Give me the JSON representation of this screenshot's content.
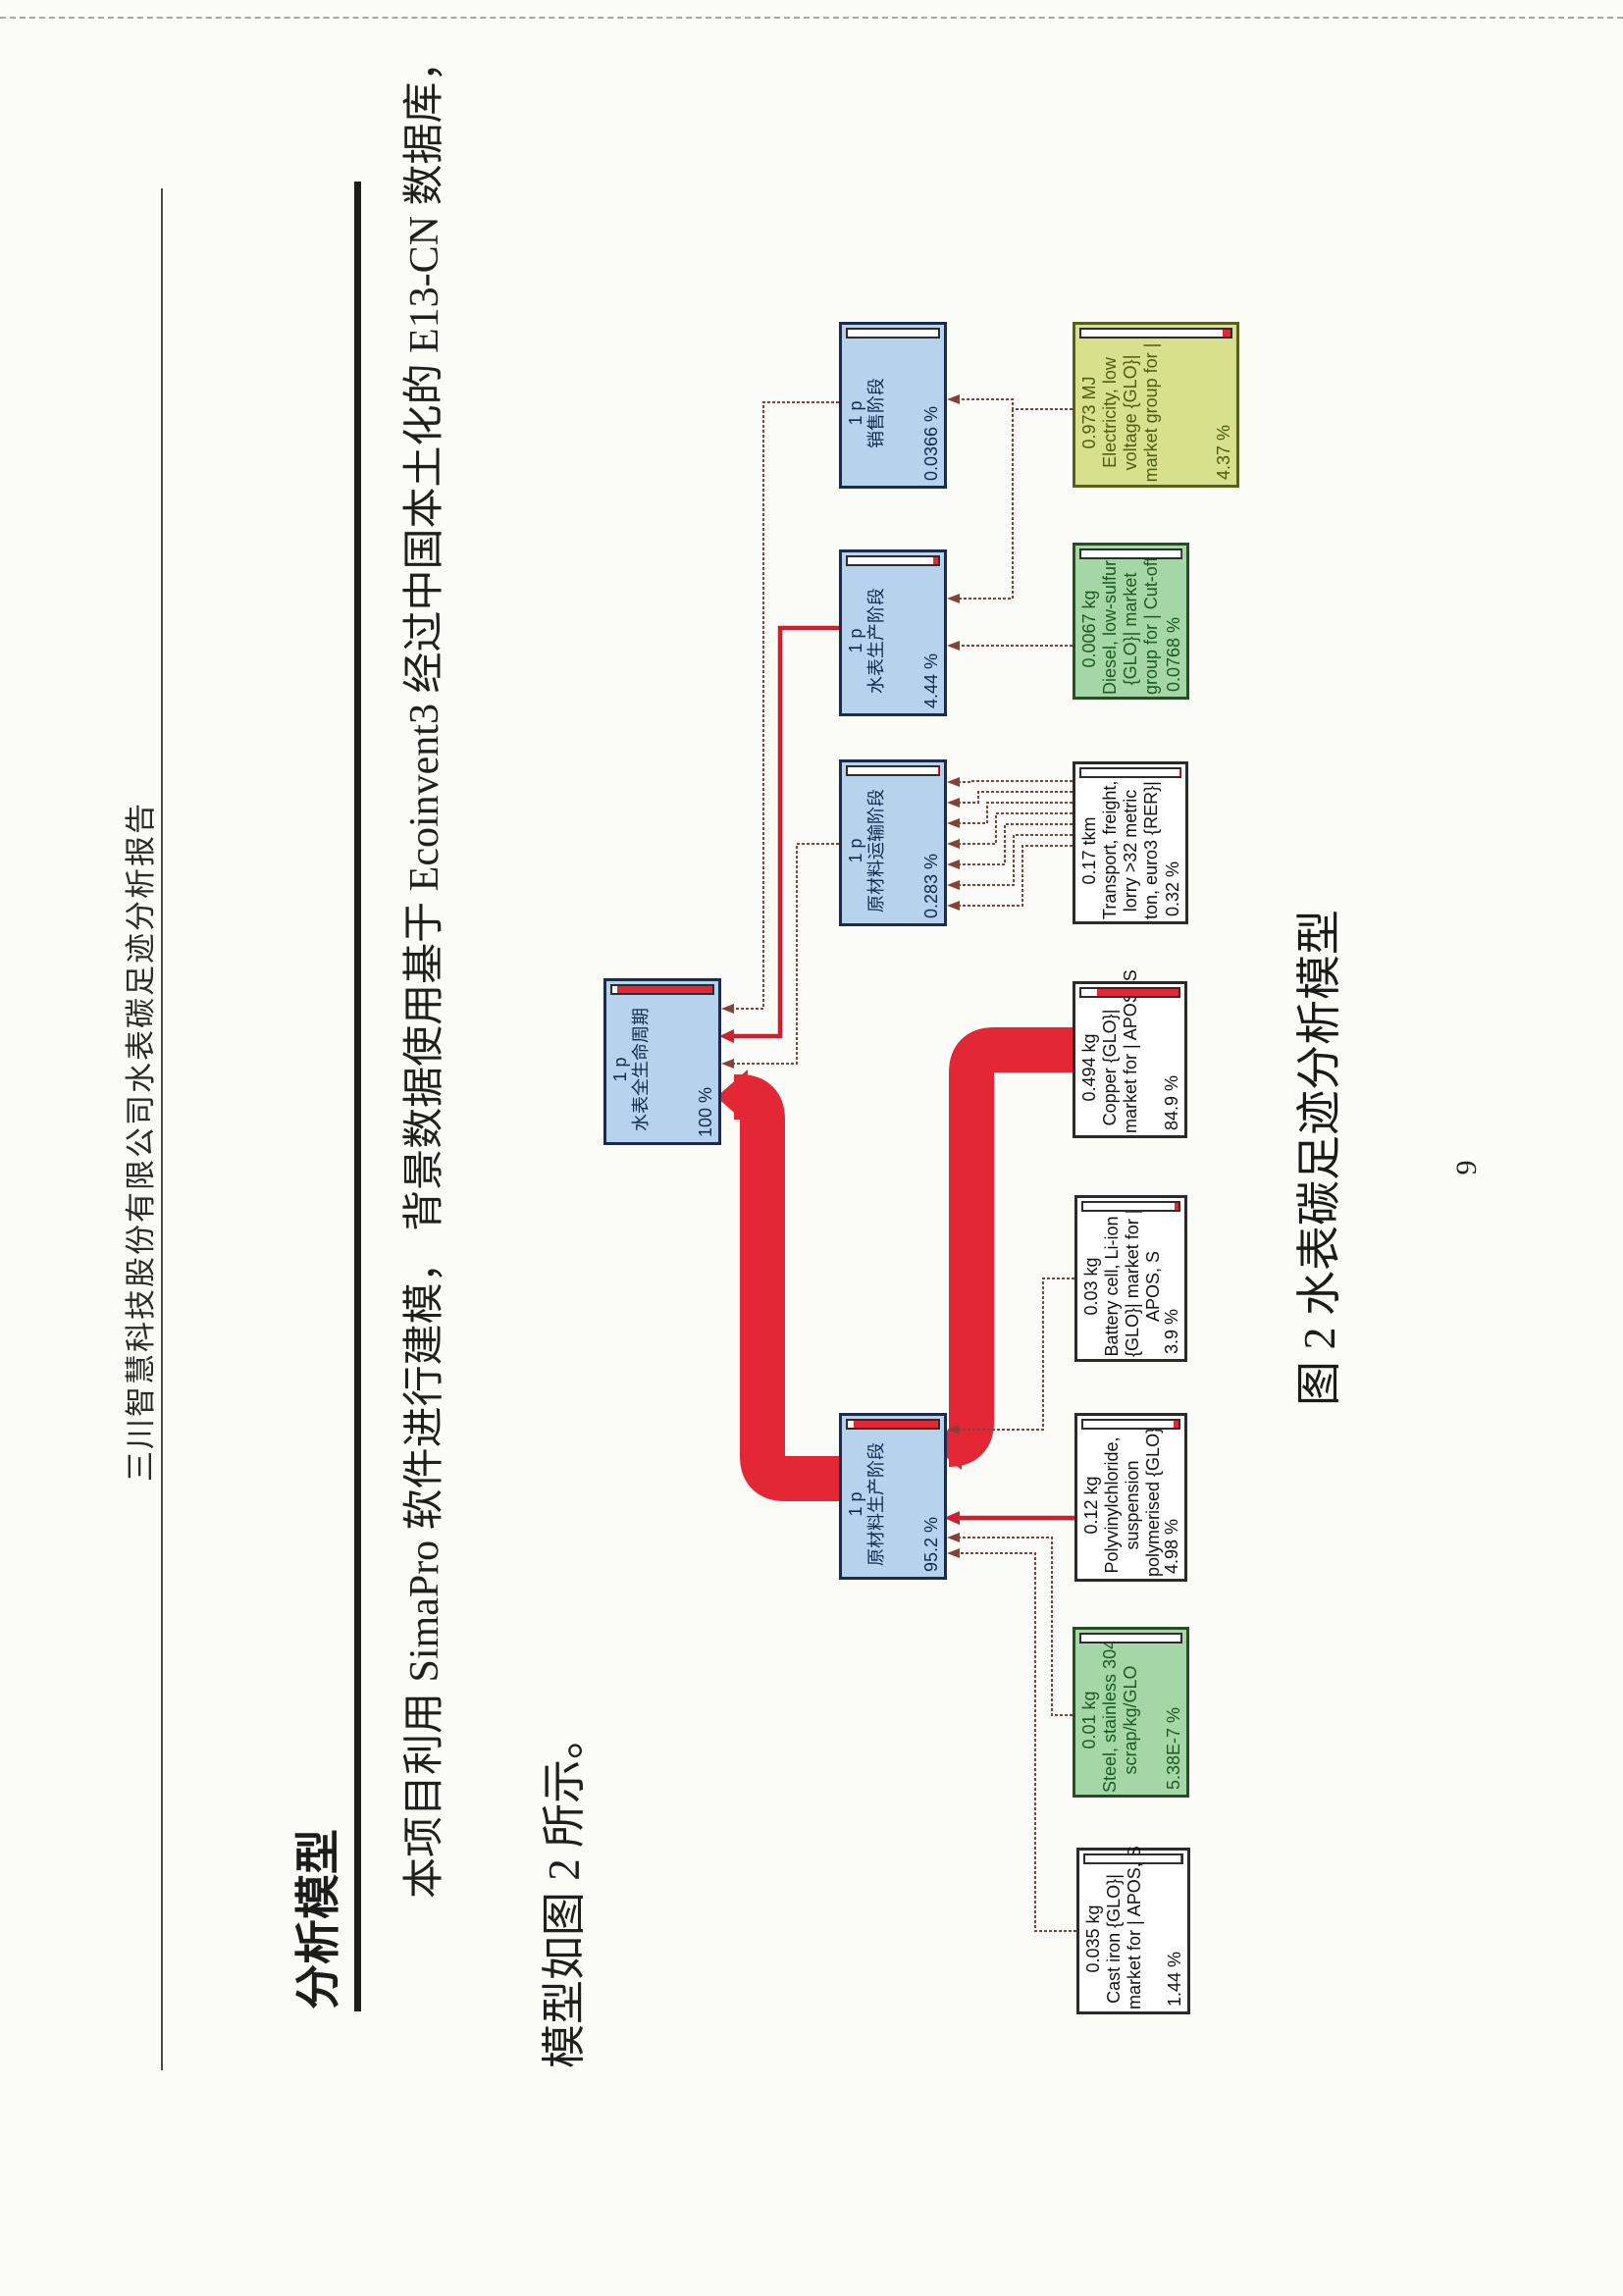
{
  "page": {
    "header_title": "三川智慧科技股份有限公司水表碳足迹分析报告",
    "page_number": "9"
  },
  "section": {
    "heading": "分析模型"
  },
  "paragraph": {
    "line1": "本项目利用 SimaPro 软件进行建模， 背景数据使用基于 Ecoinvent3 经过中国本土化的 E13-CN 数据库，",
    "line2": "模型如图 2 所示。"
  },
  "figure": {
    "caption": "图 2  水表碳足迹分析模型"
  },
  "colors": {
    "flow_red": "#e42734",
    "link_maroon": "#8a4038",
    "link_red": "#cf2030",
    "stage_blue": "#b7d2ed",
    "green_box": "#a5d6a7",
    "olive_box": "#d8e08e",
    "thermometer_red": "#e42734"
  },
  "diagram": {
    "nodes": [
      {
        "value": "1 p",
        "l1": "水表全生命周期",
        "pct": "100 %",
        "fill": 95
      },
      {
        "value": "1 p",
        "l1": "销售阶段",
        "pct": "0.0366 %",
        "fill": 0
      },
      {
        "value": "1 p",
        "l1": "水表生产阶段",
        "pct": "4.44 %",
        "fill": 5
      },
      {
        "value": "1 p",
        "l1": "原材料运输阶段",
        "pct": "0.283 %",
        "fill": 0.4
      },
      {
        "value": "1 p",
        "l1": "原材料生产阶段",
        "pct": "95.2 %",
        "fill": 93
      },
      {
        "value": "0.973 MJ",
        "l1": "Electricity, low",
        "l2": "voltage {GLO}|",
        "l3": "market group for |",
        "pct": "4.37 %",
        "fill": 5
      },
      {
        "value": "0.0067 kg",
        "l1": "Diesel, low-sulfur",
        "l2": "{GLO}| market",
        "l3": "group for | Cut-off,",
        "pct": "0.0768 %",
        "fill": 0.1
      },
      {
        "value": "0.17 tkm",
        "l1": "Transport, freight,",
        "l2": "lorry >32 metric",
        "l3": "ton, euro3 {RER}|",
        "pct": "0.32 %",
        "fill": 0.4
      },
      {
        "value": "0.494 kg",
        "l1": "Copper {GLO}|",
        "l2": "market for | APOS, S",
        "pct": "84.9 %",
        "fill": 84
      },
      {
        "value": "0.03 kg",
        "l1": "Battery cell, Li-ion",
        "l2": "{GLO}| market for |",
        "l3": "APOS, S",
        "pct": "3.9 %",
        "fill": 4
      },
      {
        "value": "0.12 kg",
        "l1": "Polyvinylchloride,",
        "l2": "suspension",
        "l3": "polymerised {GLO}|",
        "pct": "4.98 %",
        "fill": 5
      },
      {
        "value": "0.01 kg",
        "l1": "Steel, stainless 304,",
        "l2": "scrap/kg/GLO",
        "pct": "5.38E-7 %",
        "fill": 0
      },
      {
        "value": "0.035 kg",
        "l1": "Cast iron {GLO}|",
        "l2": "market for | APOS, S",
        "pct": "1.44 %",
        "fill": 1.4
      }
    ]
  }
}
